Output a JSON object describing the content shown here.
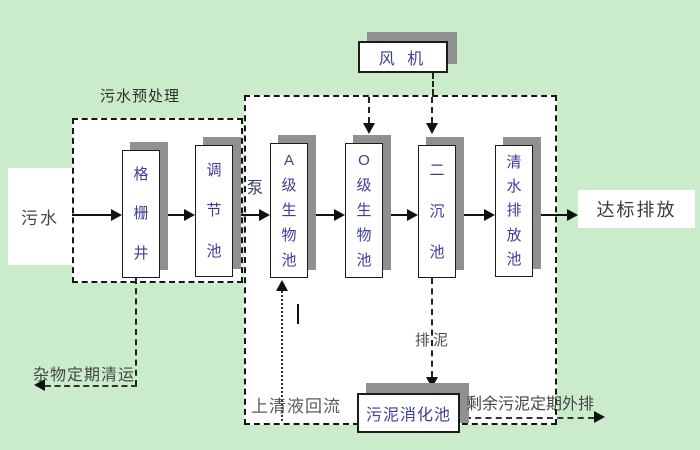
{
  "title": "A/O wastewater treatment process flow diagram",
  "colors": {
    "background": "#cbeccb",
    "panel_fill": "#ffffff",
    "box_shadow": "#909090",
    "tank_text": "#3d3d99",
    "label_text": "#454545",
    "line": "#111111"
  },
  "nodes": {
    "influent": "污水",
    "grid_well": "格栅井",
    "regulating_tank": "调节池",
    "a_bio_tank": "A级生物池",
    "o_bio_tank": "O级生物池",
    "secondary_clarifier": "二沉池",
    "clean_water_tank": "清水排放池",
    "blower": "风 机",
    "sludge_digester": "污泥消化池",
    "effluent": "达标排放"
  },
  "labels": {
    "preprocess_title": "污水预处理",
    "pump": "泵",
    "sludge_discharge": "排泥",
    "supernatant_return": "上清液回流",
    "debris_removal": "杂物定期清运",
    "excess_sludge": "剩余污泥定期外排"
  }
}
